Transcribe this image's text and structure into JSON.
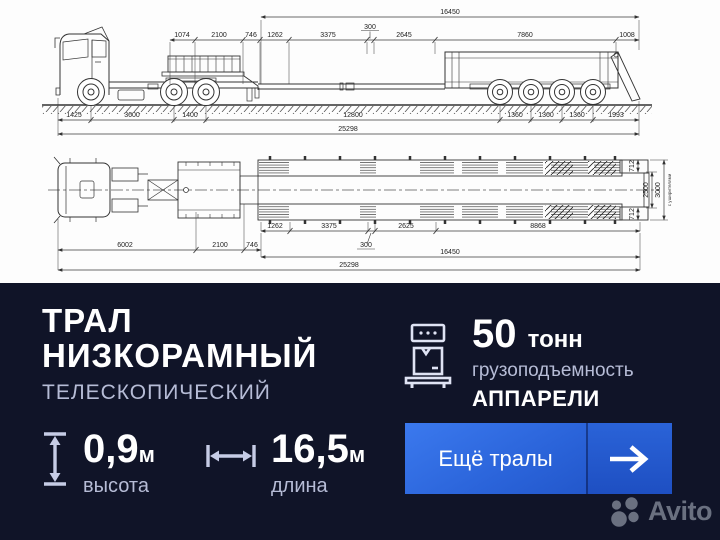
{
  "drawing": {
    "side": {
      "len_total": "16450",
      "dims_top": [
        "1074",
        "2100",
        "746",
        "1262",
        "3375",
        "300",
        "2645",
        "7860",
        "1008"
      ],
      "dims_axles": [
        "1425",
        "3600",
        "1400",
        "12800",
        "1360",
        "1360",
        "1360",
        "1993"
      ],
      "overall": "25298"
    },
    "plan": {
      "dims_upper": [
        "1262",
        "3375",
        "2625",
        "8868"
      ],
      "dim_300": "300",
      "dims_lower": [
        "6002",
        "2100",
        "746"
      ],
      "len_total": "16450",
      "overall": "25298",
      "widths": [
        "712",
        "2500",
        "712",
        "3000"
      ],
      "note": "с уширителями"
    }
  },
  "panel": {
    "title_line1": "ТРАЛ",
    "title_line2": "НИЗКОРАМНЫЙ",
    "subtitle": "ТЕЛЕСКОПИЧЕСКИЙ",
    "capacity": {
      "value": "50",
      "unit": "тонн",
      "label": "грузоподъемность",
      "extra": "АППАРЕЛИ"
    },
    "height": {
      "value": "0,9",
      "unit": "м",
      "label": "высота"
    },
    "length": {
      "value": "16,5",
      "unit": "м",
      "label": "длина"
    },
    "cta_label": "Ещё тралы",
    "brand": "Avito"
  },
  "colors": {
    "panel_bg": "#101428",
    "button_blue_light": "#3b79ee",
    "button_blue_dark": "#1d4ec0",
    "muted_text": "#b6bcd6",
    "brand_gray": "#6a7080",
    "drawing_line": "#333333"
  }
}
